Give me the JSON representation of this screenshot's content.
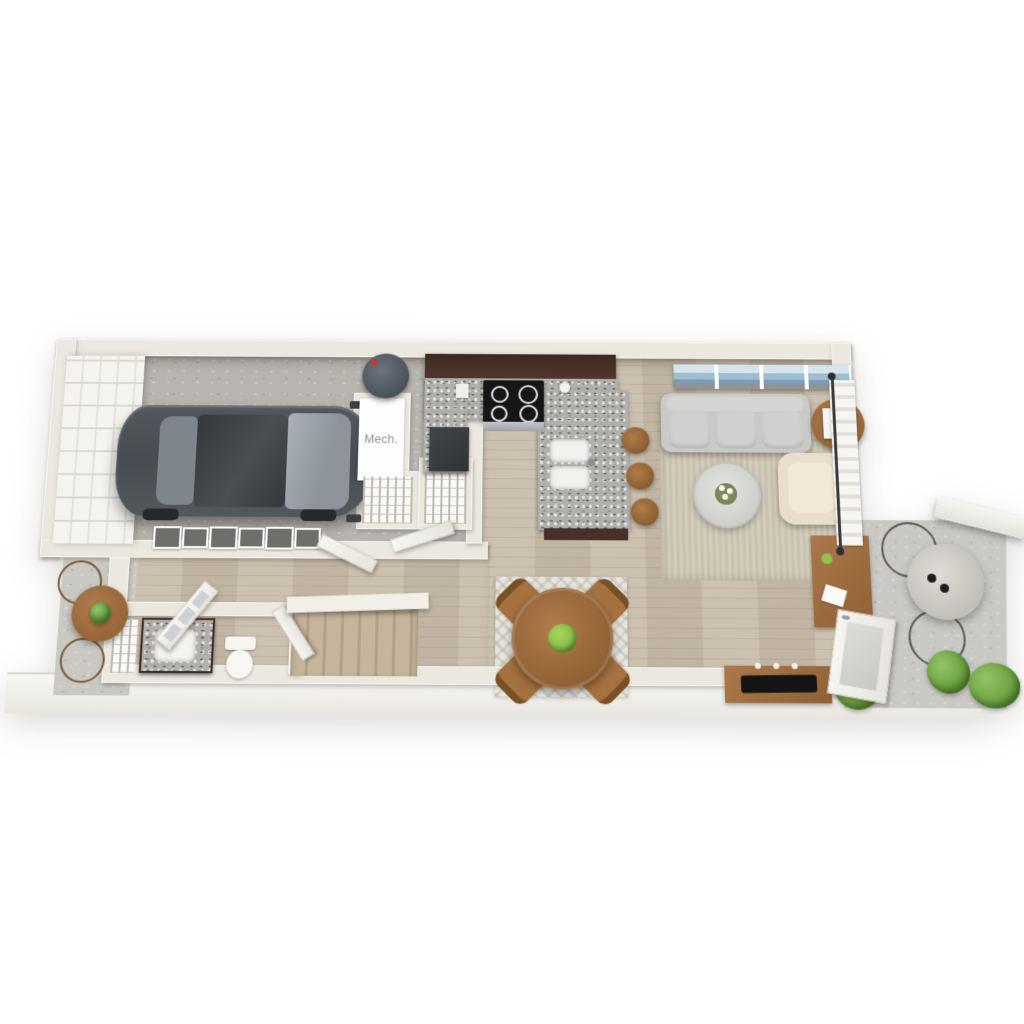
{
  "plan": {
    "type": "3d-floor-plan-top-view",
    "labels": {
      "mech_room": "Mech."
    },
    "palette": {
      "background": "#ffffff",
      "wall": "#ebe8df",
      "floor_wood": "#c9bdab",
      "floor_concrete": "#b8b5af",
      "patio_concrete": "#c9c8c2",
      "slab": "#f3f2ed",
      "cabinet_espresso": "#47302a",
      "countertop_granite": "#b0afac",
      "car_gray": "#565b60",
      "sofa_gray": "#c9cac8",
      "armchair_cream": "#e9ddcb",
      "wood_furniture": "#a0713f",
      "plant_green": "#6da746",
      "art_blue": "#9dbdd3",
      "rug_living": "#cfc8b6",
      "rug_dining": "#e6e4dd"
    },
    "inventory": {
      "garage": [
        "sedan car",
        "garage door",
        "water heater",
        "mech closet",
        "wire shelf closet"
      ],
      "kitchen": [
        "range",
        "refrigerator",
        "granite peninsula",
        "double sink",
        "3 bar stools",
        "pantry"
      ],
      "living_room": [
        "3-seat sofa",
        "panoramic wall art",
        "side table with lamp",
        "armchair",
        "round coffee table",
        "area rug",
        "desk",
        "tv console with tv",
        "plant",
        "curtained window",
        "glass patio door"
      ],
      "dining": [
        "round wood table",
        "4 chairs",
        "patterned rug",
        "fruit bowl"
      ],
      "entry_hall": [
        "front door",
        "6 gallery frames",
        "staircase"
      ],
      "bathroom": [
        "vanity with sink",
        "toilet",
        "shelf unit"
      ],
      "patios": [
        "bistro table",
        "pedestal table",
        "wire chairs",
        "plants"
      ]
    }
  }
}
